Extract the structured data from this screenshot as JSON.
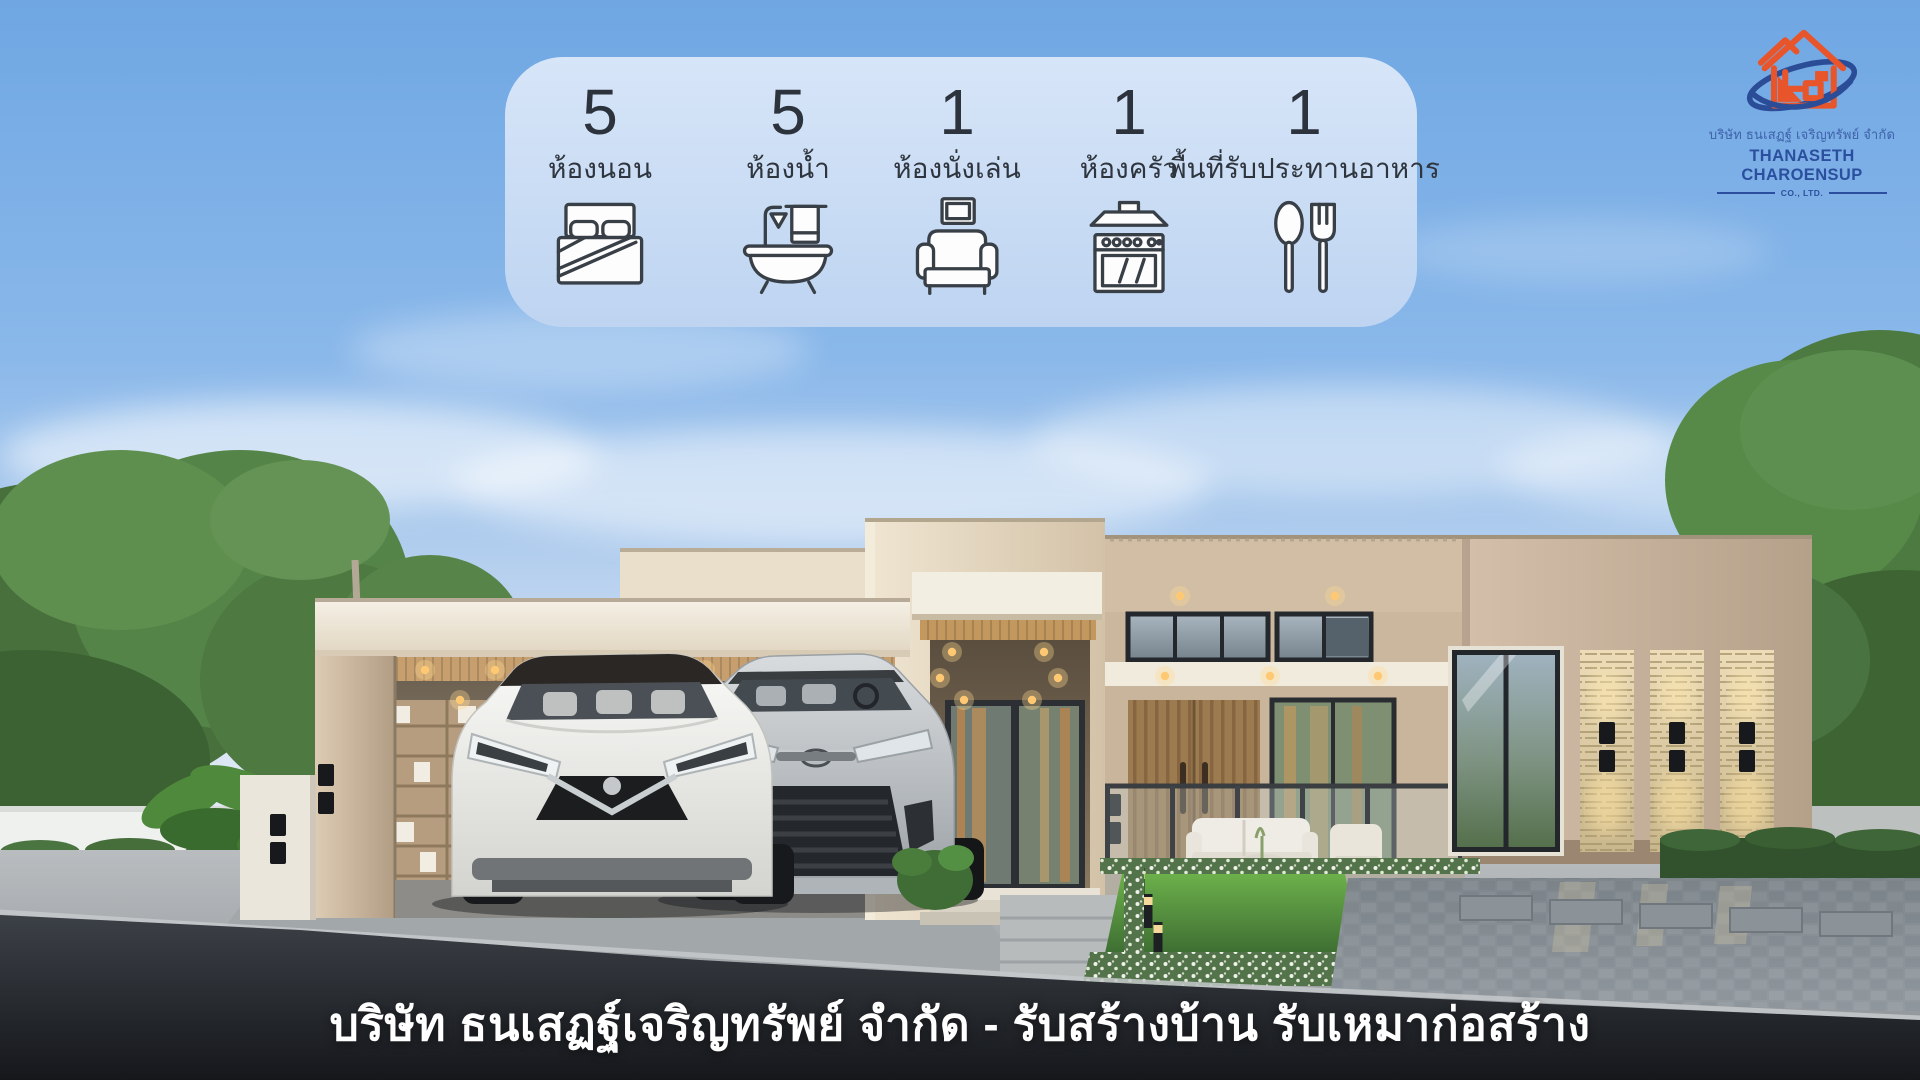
{
  "panel": {
    "items": [
      {
        "value": "5",
        "label": "ห้องนอน",
        "icon": "bed-icon"
      },
      {
        "value": "5",
        "label": "ห้องน้ำ",
        "icon": "bathtub-icon"
      },
      {
        "value": "1",
        "label": "ห้องนั่งเล่น",
        "icon": "armchair-icon"
      },
      {
        "value": "1",
        "label": "ห้องครัว",
        "icon": "stove-icon"
      },
      {
        "value": "1",
        "label": "พื้นที่รับประทานอาหาร",
        "icon": "cutlery-icon"
      }
    ]
  },
  "logo": {
    "thai_name": "บริษัท ธนเสฏฐ์ เจริญทรัพย์ จำกัด",
    "english_name": "THANASETH CHAROENSUP",
    "suffix": "CO., LTD."
  },
  "caption": "บริษัท ธนเสฏฐ์เจริญทรัพย์ จำกัด - รับสร้างบ้าน รับเหมาก่อสร้าง",
  "colors": {
    "sky_top": "#6fa7e3",
    "panel_blue": "#c9dcf4",
    "icon_ink": "#383f47",
    "wall_beige": "#cdb9a1",
    "wood": "#c79f6f",
    "stone": "#e6d8b4",
    "accent_orange": "#e8552b",
    "logo_blue": "#2b4f9e",
    "road_dark": "#1a1d21",
    "caption_text": "#ffffff",
    "grass_green": "#58a13e"
  }
}
